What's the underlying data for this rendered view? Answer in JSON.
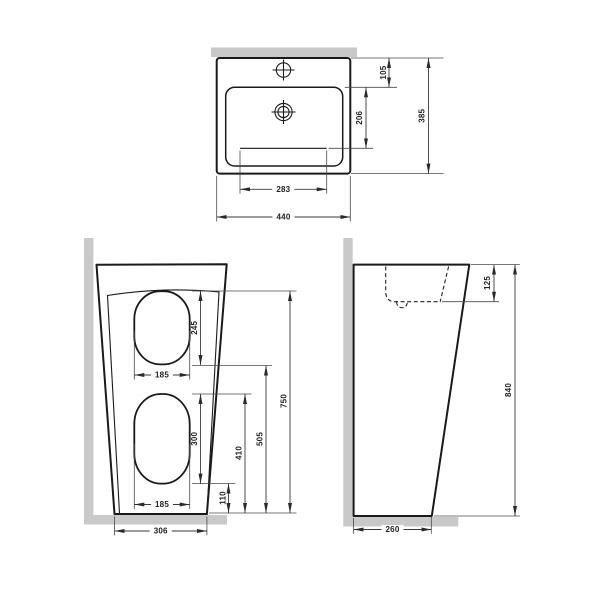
{
  "colors": {
    "outline": "#1a1a1a",
    "dimension_line": "#3a3a3a",
    "wall_floor_gray": "#c9c9c9",
    "background": "#ffffff"
  },
  "top_view": {
    "dims": {
      "overall_width": "440",
      "overall_depth": "385",
      "basin_opening_width": "283",
      "basin_depth": "206",
      "back_ledge_depth": "105"
    }
  },
  "front_view": {
    "dims": {
      "panel_height": "750",
      "upper_cutout_height": "245",
      "upper_cutout_width": "185",
      "lower_cutout_height": "300",
      "lower_cutout_width": "185",
      "lower_cutout_to_floor": "110",
      "floor_to_lower_cutout_top": "410",
      "floor_to_upper_cutout_bottom": "505",
      "base_width": "306"
    }
  },
  "side_view": {
    "dims": {
      "overall_height": "840",
      "basin_inner_depth": "125",
      "base_depth": "260"
    }
  }
}
